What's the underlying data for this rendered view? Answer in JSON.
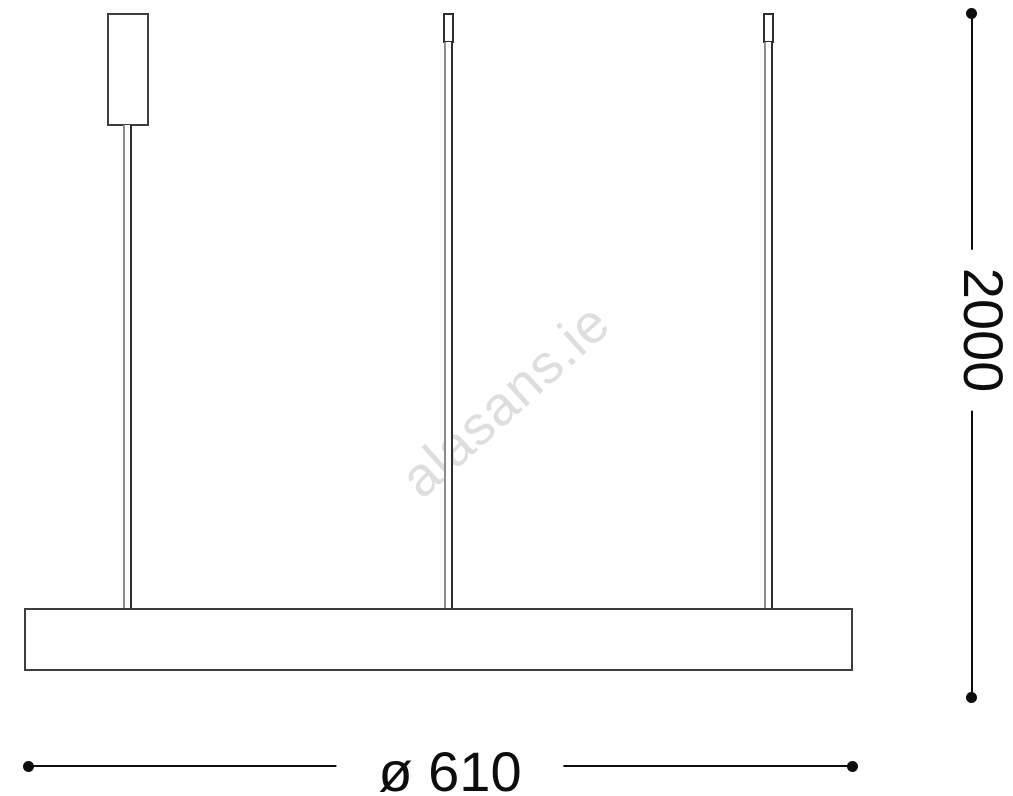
{
  "watermark": {
    "text": "alasans.ie"
  },
  "dimensions": {
    "height": {
      "label": "2000"
    },
    "diameter": {
      "label": "ø 610"
    }
  },
  "colors": {
    "background": "#ffffff",
    "outline": "#3e3e3e",
    "rod_light": "#8c8c8c",
    "rod_dark": "#2e2e2e",
    "dimension": "#0d0d0d",
    "watermark": "#dedede"
  }
}
